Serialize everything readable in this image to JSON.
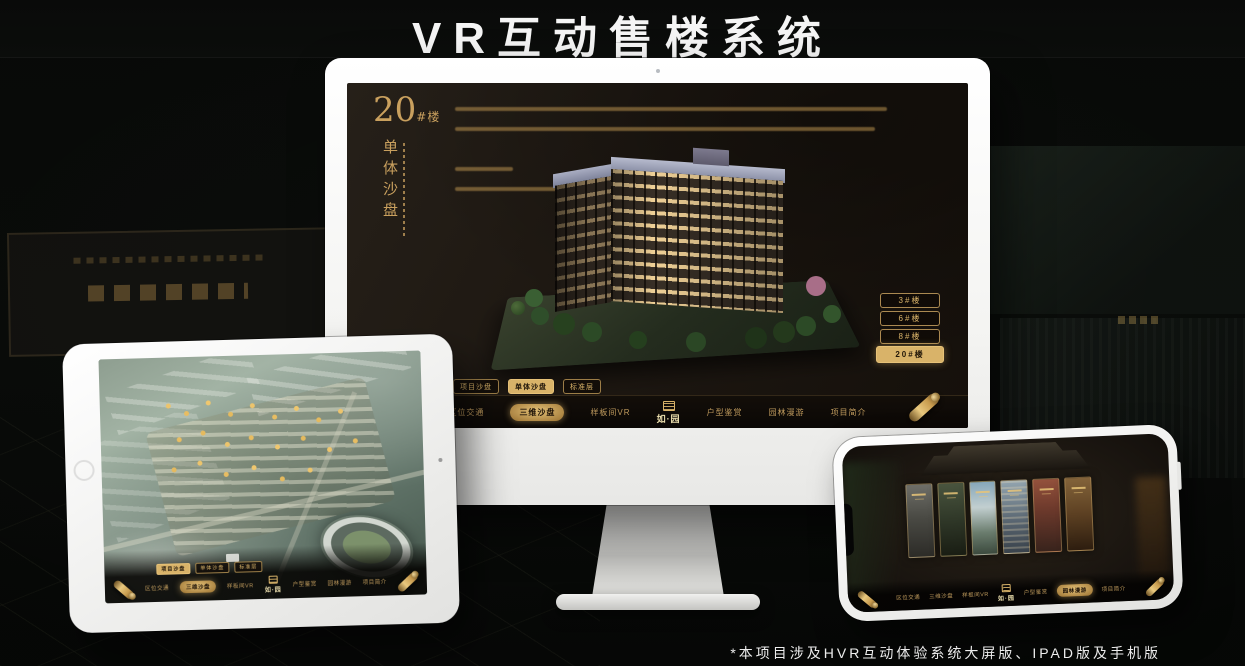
{
  "page": {
    "title": "VR互动售楼系统",
    "footnote": "*本项目涉及HVR互动体验系统大屏版、IPAD版及手机版"
  },
  "colors": {
    "accent_gold": "#D9B369",
    "gold_text": "#C9A05E",
    "screen_background": "#1A140E",
    "nav_background": "#0B0806",
    "device_body": "#F7F7F5",
    "page_background": "#0B0D0B",
    "title_text": "#F5F5F5"
  },
  "desktop": {
    "heading": {
      "number": "20",
      "suffix": "#楼",
      "subtitle": "单体沙盘"
    },
    "building_buttons": [
      {
        "label": "3#楼",
        "active": false
      },
      {
        "label": "6#楼",
        "active": false
      },
      {
        "label": "8#楼",
        "active": false
      },
      {
        "label": "20#楼",
        "active": true
      }
    ],
    "view_tabs": [
      {
        "label": "项目沙盘",
        "active": false
      },
      {
        "label": "单体沙盘",
        "active": true
      },
      {
        "label": "标准层",
        "active": false
      }
    ],
    "nav_items": [
      {
        "label": "区位交通",
        "active": false
      },
      {
        "label": "三维沙盘",
        "active": true
      },
      {
        "label": "样板间VR",
        "active": false
      },
      {
        "label": "户型鉴赏",
        "active": false
      },
      {
        "label": "园林漫游",
        "active": false
      },
      {
        "label": "项目简介",
        "active": false
      }
    ],
    "logo": "如·园"
  },
  "tablet": {
    "view_tabs": [
      {
        "label": "项目沙盘",
        "active": true
      },
      {
        "label": "单体沙盘",
        "active": false
      },
      {
        "label": "标准层",
        "active": false
      }
    ],
    "nav_items": [
      {
        "label": "区位交通",
        "active": false
      },
      {
        "label": "三维沙盘",
        "active": true
      },
      {
        "label": "样板间VR",
        "active": false
      },
      {
        "label": "户型鉴赏",
        "active": false
      },
      {
        "label": "园林漫游",
        "active": false
      },
      {
        "label": "项目简介",
        "active": false
      }
    ],
    "logo": "如·园"
  },
  "phone": {
    "nav_items": [
      {
        "label": "区位交通",
        "active": false
      },
      {
        "label": "三维沙盘",
        "active": false
      },
      {
        "label": "样板间VR",
        "active": false
      },
      {
        "label": "户型鉴赏",
        "active": false
      },
      {
        "label": "园林漫游",
        "active": true
      },
      {
        "label": "项目简介",
        "active": false
      }
    ],
    "logo": "如·园"
  }
}
